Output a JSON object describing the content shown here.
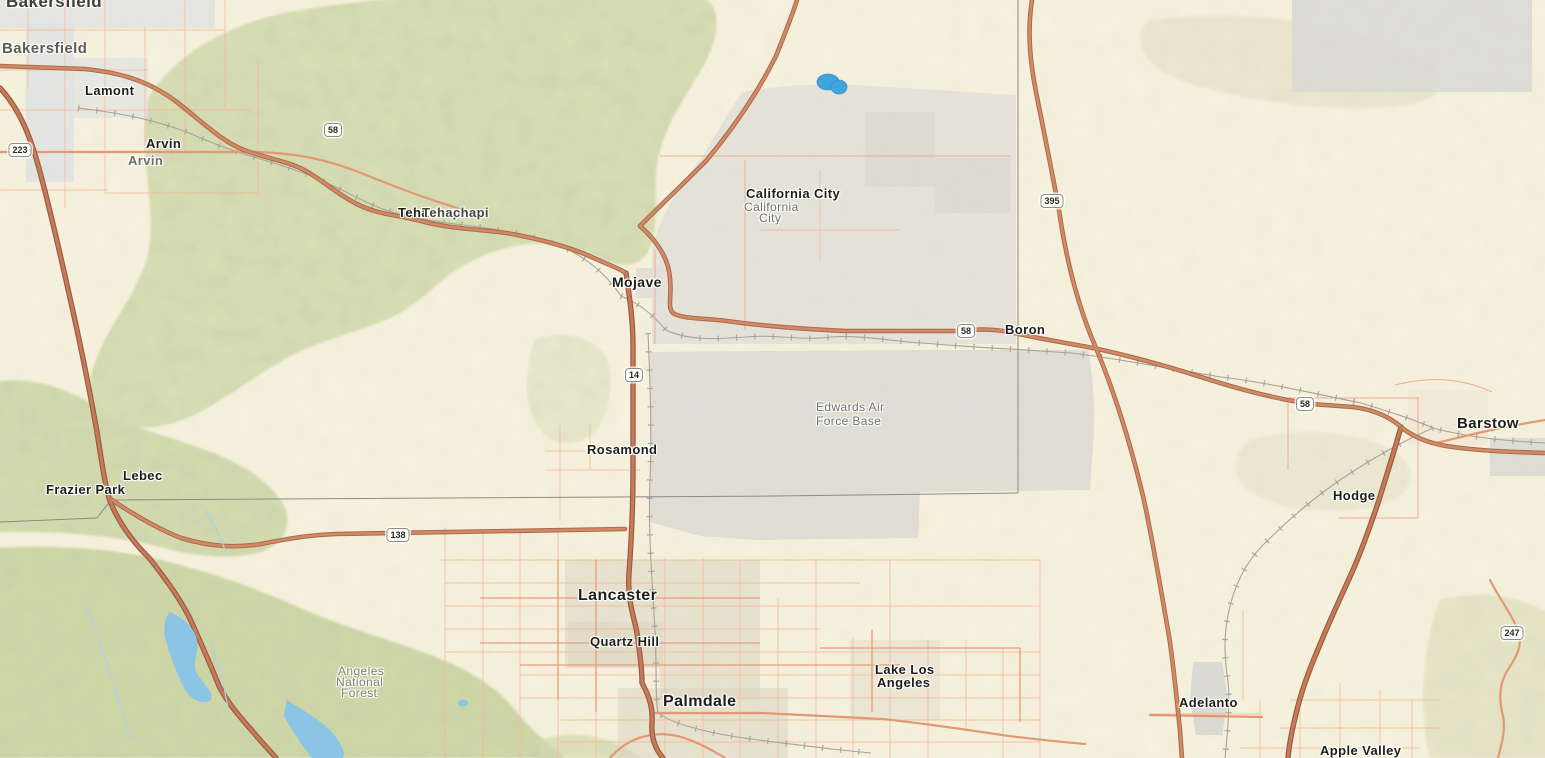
{
  "colors": {
    "land": "#f6f2de",
    "terrain_green": "#dbe2b4",
    "forest_green": "#d0daa4",
    "desert_tan": "#e7e2c8",
    "urban_gray": "#e2e0d8",
    "military_gray": "#e0ded6",
    "urban_blue_gray": "#e0e4e6",
    "water_blue": "#42a4dc",
    "lake_light_blue": "#8cc4e6",
    "highway_fill": "#d28a64",
    "highway_casing": "#a96b4c",
    "freeway_fill": "#c57b57",
    "freeway_casing": "#9c5c43",
    "secondary_road": "#e29873",
    "minor_road": "#f3b797",
    "boundary_pink": "#f0a58a",
    "railroad_gray": "#a6a49a",
    "county_line_gray": "#8b8b83",
    "label_dark": "#1d1d1a",
    "label_gray": "#6e6e64",
    "forest_label_gray": "#7d8069"
  },
  "labels": [
    {
      "id": "bakersfield-city-large",
      "text": "Bakersfield",
      "x": 6,
      "y": -7,
      "size": 17,
      "weight": "bold",
      "color": "#3f3f38"
    },
    {
      "id": "bakersfield-area",
      "text": "Bakersfield",
      "x": 2,
      "y": 41,
      "size": 15,
      "weight": "bold",
      "color": "#5c5c54"
    },
    {
      "id": "lamont",
      "text": "Lamont",
      "x": 85,
      "y": 84,
      "size": 13,
      "weight": "bold",
      "color": "#1d1d1a"
    },
    {
      "id": "arvin-city",
      "text": "Arvin",
      "x": 146,
      "y": 137,
      "size": 13,
      "weight": "bold",
      "color": "#1d1d1a"
    },
    {
      "id": "arvin-area",
      "text": "Arvin",
      "x": 128,
      "y": 154,
      "size": 13,
      "weight": "bold",
      "color": "#6e6e64"
    },
    {
      "id": "tehachapi-a",
      "text": "Tehachapi",
      "x": 398,
      "y": 206,
      "size": 13,
      "weight": "bold",
      "color": "#1d1d1a"
    },
    {
      "id": "tehachapi-b",
      "text": "Tehachapi",
      "x": 422,
      "y": 206,
      "size": 13,
      "weight": "bold",
      "color": "#46463f"
    },
    {
      "id": "california-city",
      "text": "California City",
      "x": 746,
      "y": 187,
      "size": 13,
      "weight": "bold",
      "color": "#1d1d1a"
    },
    {
      "id": "california-city-area-1",
      "text": "California",
      "x": 744,
      "y": 201,
      "size": 12,
      "weight": "normal",
      "color": "#6e6e64"
    },
    {
      "id": "california-city-area-2",
      "text": "City",
      "x": 759,
      "y": 212,
      "size": 12,
      "weight": "normal",
      "color": "#6e6e64"
    },
    {
      "id": "mojave",
      "text": "Mojave",
      "x": 612,
      "y": 275,
      "size": 14,
      "weight": "bold",
      "color": "#1d1d1a"
    },
    {
      "id": "boron",
      "text": "Boron",
      "x": 1005,
      "y": 323,
      "size": 13,
      "weight": "bold",
      "color": "#1d1d1a"
    },
    {
      "id": "edwards-afb-1",
      "text": "Edwards Air",
      "x": 816,
      "y": 401,
      "size": 12,
      "weight": "normal",
      "color": "#72726a"
    },
    {
      "id": "edwards-afb-2",
      "text": "Force Base",
      "x": 816,
      "y": 415,
      "size": 12,
      "weight": "normal",
      "color": "#72726a"
    },
    {
      "id": "rosamond",
      "text": "Rosamond",
      "x": 587,
      "y": 443,
      "size": 13,
      "weight": "bold",
      "color": "#1d1d1a"
    },
    {
      "id": "lebec",
      "text": "Lebec",
      "x": 123,
      "y": 469,
      "size": 13,
      "weight": "bold",
      "color": "#1d1d1a"
    },
    {
      "id": "frazier-park",
      "text": "Frazier Park",
      "x": 46,
      "y": 483,
      "size": 13,
      "weight": "bold",
      "color": "#1d1d1a"
    },
    {
      "id": "lancaster",
      "text": "Lancaster",
      "x": 578,
      "y": 588,
      "size": 16,
      "weight": "bold",
      "color": "#1d1d1a"
    },
    {
      "id": "quartz-hill",
      "text": "Quartz Hill",
      "x": 590,
      "y": 635,
      "size": 13,
      "weight": "bold",
      "color": "#1d1d1a"
    },
    {
      "id": "palmdale",
      "text": "Palmdale",
      "x": 663,
      "y": 694,
      "size": 16,
      "weight": "bold",
      "color": "#1d1d1a"
    },
    {
      "id": "lake-los-angeles-1",
      "text": "Lake Los",
      "x": 875,
      "y": 663,
      "size": 13,
      "weight": "bold",
      "color": "#1d1d1a"
    },
    {
      "id": "lake-los-angeles-2",
      "text": "Angeles",
      "x": 877,
      "y": 676,
      "size": 13,
      "weight": "bold",
      "color": "#1d1d1a"
    },
    {
      "id": "angeles-national-forest-1",
      "text": "Angeles",
      "x": 338,
      "y": 665,
      "size": 12,
      "weight": "normal",
      "color": "#7d8069"
    },
    {
      "id": "angeles-national-forest-2",
      "text": "National",
      "x": 336,
      "y": 676,
      "size": 12,
      "weight": "normal",
      "color": "#7d8069"
    },
    {
      "id": "angeles-national-forest-3",
      "text": "Forest",
      "x": 341,
      "y": 687,
      "size": 12,
      "weight": "normal",
      "color": "#7d8069"
    },
    {
      "id": "hodge",
      "text": "Hodge",
      "x": 1333,
      "y": 489,
      "size": 13,
      "weight": "bold",
      "color": "#1d1d1a"
    },
    {
      "id": "barstow",
      "text": "Barstow",
      "x": 1457,
      "y": 416,
      "size": 15,
      "weight": "bold",
      "color": "#1d1d1a"
    },
    {
      "id": "adelanto",
      "text": "Adelanto",
      "x": 1179,
      "y": 696,
      "size": 13,
      "weight": "bold",
      "color": "#1d1d1a"
    },
    {
      "id": "apple-valley",
      "text": "Apple Valley",
      "x": 1320,
      "y": 744,
      "size": 13,
      "weight": "bold",
      "color": "#1d1d1a"
    }
  ],
  "shields": [
    {
      "route": "223",
      "x": 20,
      "y": 150
    },
    {
      "route": "58",
      "x": 333,
      "y": 130
    },
    {
      "route": "14",
      "x": 634,
      "y": 375
    },
    {
      "route": "58",
      "x": 966,
      "y": 331
    },
    {
      "route": "395",
      "x": 1052,
      "y": 201
    },
    {
      "route": "138",
      "x": 398,
      "y": 535
    },
    {
      "route": "58",
      "x": 1305,
      "y": 404
    },
    {
      "route": "247",
      "x": 1512,
      "y": 633
    }
  ]
}
